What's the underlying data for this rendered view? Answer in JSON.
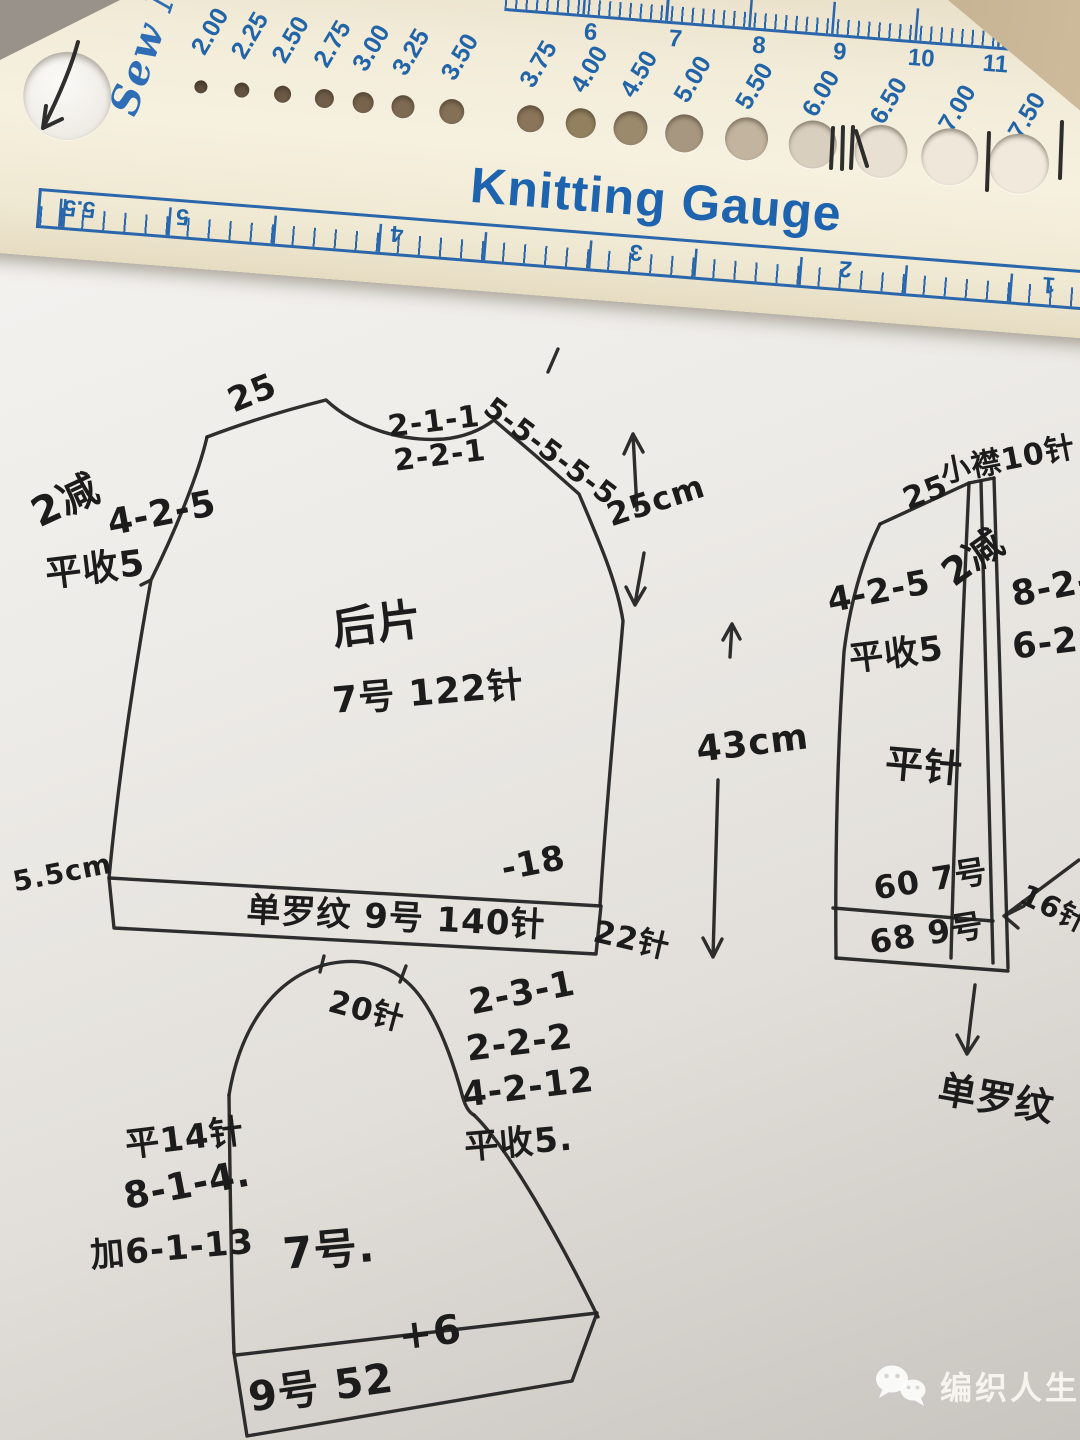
{
  "ruler": {
    "brand_script": "Sew Mate",
    "registered_mark": "®",
    "title": "Knitting Gauge",
    "big_hole_label": "10.0",
    "hole_sizes": [
      "2.00",
      "2.25",
      "2.50",
      "2.75",
      "3.00",
      "3.25",
      "3.50",
      "3.75",
      "4.00",
      "4.50",
      "5.00",
      "5.50",
      "6.00",
      "6.50",
      "7.00",
      "7.50"
    ],
    "inch_marks": [
      "6",
      "7",
      "8",
      "9",
      "10",
      "11",
      "12"
    ],
    "cm_marks": [
      "5.5",
      "5",
      "4",
      "3",
      "2",
      "1"
    ],
    "colors": {
      "plastic_cream": "#f2ecd9",
      "print_blue": "#2264a8"
    }
  },
  "diagram": {
    "pen_color": "#232323",
    "back_piece": {
      "title": "后片",
      "needle_and_stitches": "7号 122针",
      "shoulder_left": "25",
      "neck_rate_1": "2-1-1",
      "neck_rate_2": "2-2-1",
      "shoulder_right_rate": "5-5-5-5-5",
      "armhole_decrease": "2减",
      "armhole_rate": "4-2-5",
      "armhole_bindoff": "平收5",
      "armhole_depth": "25cm",
      "body_length": "43cm",
      "hem_height": "5.5cm",
      "hem_minus": "-18",
      "hem_label": "单罗纹 9号 140针",
      "hem_rows": "22针"
    },
    "front_piece": {
      "shoulder": "25",
      "placket": "小襟10针",
      "decrease": "2减",
      "rate_1": "8-2-3",
      "rate_2": "6-2-7",
      "armhole_rate": "4-2-5",
      "armhole_bindoff": "平收5",
      "stitch_type": "平针",
      "count_upper": "60 7号",
      "count_lower": "68 9号",
      "edge_note": "16针",
      "hem_note": "单罗纹"
    },
    "sleeve": {
      "cap_top": "20针",
      "cap_rate_1": "2-3-1",
      "cap_rate_2": "2-2-2",
      "cap_rate_3": "4-2-12",
      "cap_bindoff": "平收5.",
      "straight_rows": "平14针",
      "rate_note": "8-1-4.",
      "increase_rate": "加6-1-13",
      "needle": "7号.",
      "cuff_plus": "+6",
      "cuff_label": "9号 52"
    }
  },
  "watermark": {
    "label": "编织人生"
  }
}
